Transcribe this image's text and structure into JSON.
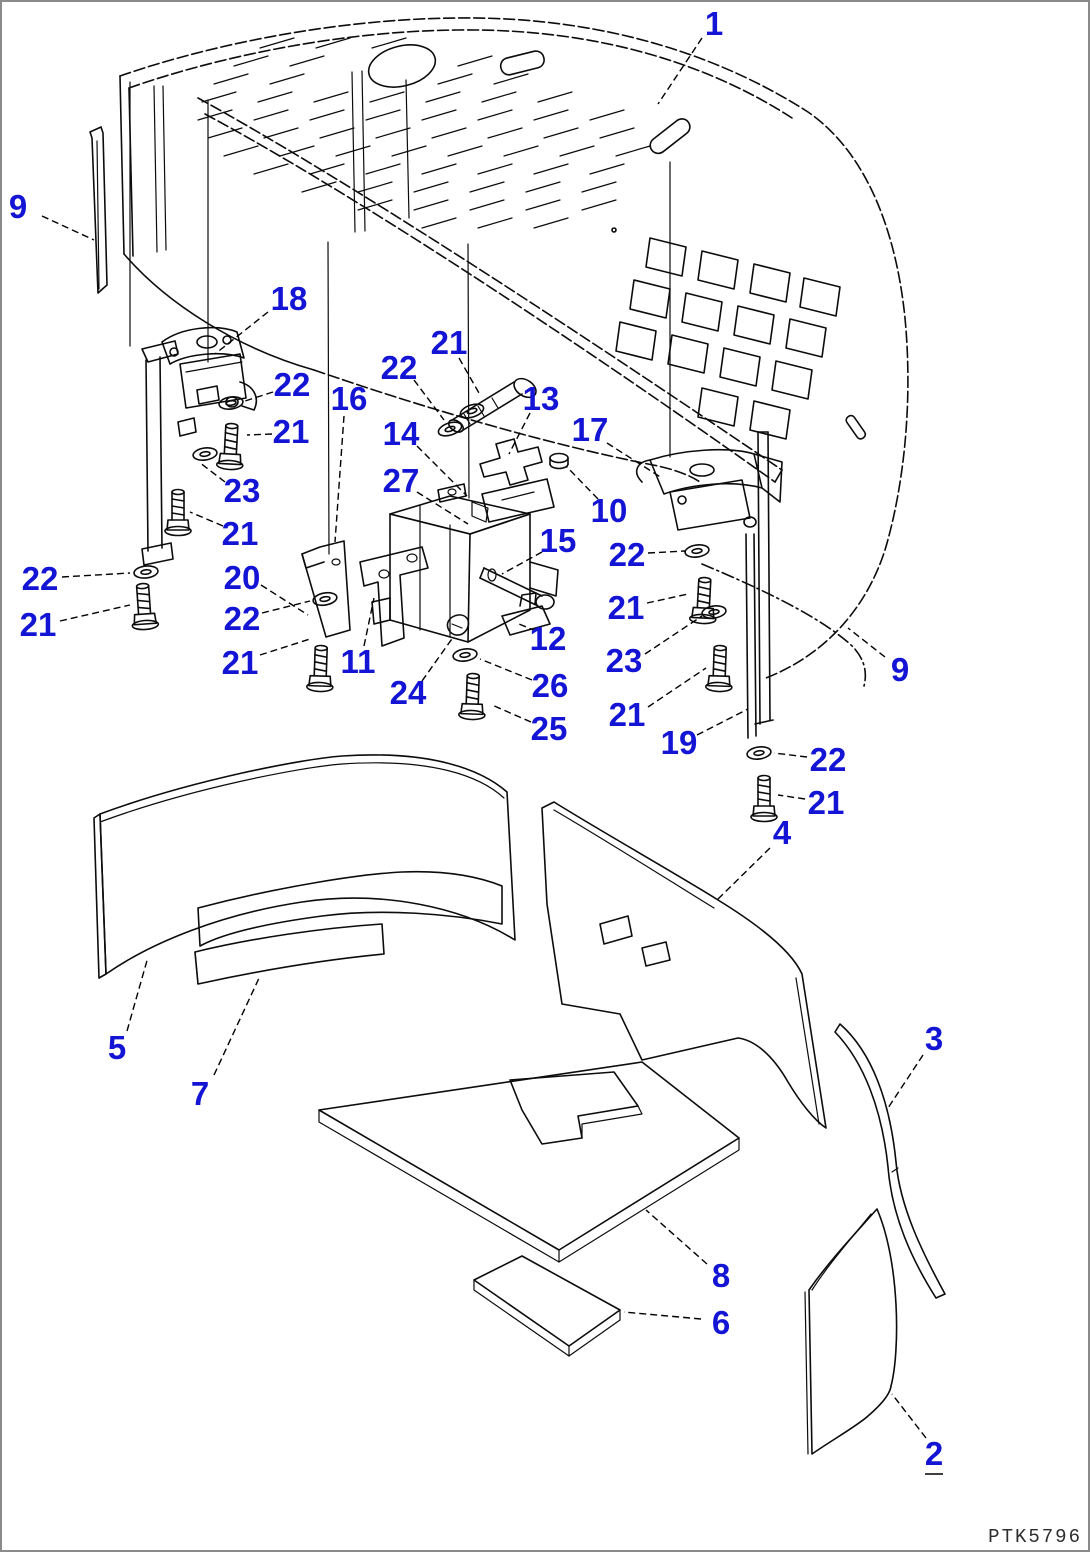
{
  "page": {
    "drawing_code": "PTK5796",
    "background": "#ffffff",
    "border_color": "#8a8a8a"
  },
  "style": {
    "callout_color": "#1414d4",
    "line_color": "#0c0c0c"
  },
  "callouts": [
    {
      "label": "1",
      "x": 712,
      "y": 22,
      "x1": 700,
      "y1": 36,
      "x2": 656,
      "y2": 102
    },
    {
      "label": "9",
      "x": 16,
      "y": 205,
      "x1": 40,
      "y1": 214,
      "x2": 92,
      "y2": 238
    },
    {
      "label": "18",
      "x": 287,
      "y": 297,
      "x1": 266,
      "y1": 310,
      "x2": 213,
      "y2": 352
    },
    {
      "label": "22",
      "x": 290,
      "y": 383,
      "x1": 271,
      "y1": 390,
      "x2": 243,
      "y2": 399
    },
    {
      "label": "21",
      "x": 289,
      "y": 430,
      "x1": 270,
      "y1": 432,
      "x2": 245,
      "y2": 433
    },
    {
      "label": "16",
      "x": 347,
      "y": 397,
      "x1": 342,
      "y1": 414,
      "x2": 333,
      "y2": 540
    },
    {
      "label": "22",
      "x": 397,
      "y": 366,
      "x1": 412,
      "y1": 378,
      "x2": 442,
      "y2": 418
    },
    {
      "label": "21",
      "x": 447,
      "y": 341,
      "x1": 457,
      "y1": 356,
      "x2": 477,
      "y2": 391
    },
    {
      "label": "13",
      "x": 539,
      "y": 397,
      "x1": 528,
      "y1": 411,
      "x2": 507,
      "y2": 452
    },
    {
      "label": "14",
      "x": 399,
      "y": 432,
      "x1": 415,
      "y1": 444,
      "x2": 465,
      "y2": 494
    },
    {
      "label": "17",
      "x": 588,
      "y": 428,
      "x1": 605,
      "y1": 441,
      "x2": 660,
      "y2": 476
    },
    {
      "label": "27",
      "x": 399,
      "y": 479,
      "x1": 415,
      "y1": 490,
      "x2": 466,
      "y2": 522
    },
    {
      "label": "10",
      "x": 607,
      "y": 509,
      "x1": 596,
      "y1": 497,
      "x2": 564,
      "y2": 464
    },
    {
      "label": "23",
      "x": 240,
      "y": 489,
      "x1": 223,
      "y1": 480,
      "x2": 197,
      "y2": 460
    },
    {
      "label": "21",
      "x": 238,
      "y": 532,
      "x1": 221,
      "y1": 524,
      "x2": 188,
      "y2": 510
    },
    {
      "label": "15",
      "x": 556,
      "y": 539,
      "x1": 540,
      "y1": 550,
      "x2": 500,
      "y2": 572
    },
    {
      "label": "22",
      "x": 625,
      "y": 553,
      "x1": 646,
      "y1": 551,
      "x2": 683,
      "y2": 549
    },
    {
      "label": "20",
      "x": 240,
      "y": 576,
      "x1": 259,
      "y1": 583,
      "x2": 306,
      "y2": 613
    },
    {
      "label": "22",
      "x": 38,
      "y": 577,
      "x1": 60,
      "y1": 575,
      "x2": 128,
      "y2": 571
    },
    {
      "label": "21",
      "x": 36,
      "y": 623,
      "x1": 58,
      "y1": 619,
      "x2": 128,
      "y2": 603
    },
    {
      "label": "22",
      "x": 240,
      "y": 617,
      "x1": 260,
      "y1": 611,
      "x2": 308,
      "y2": 599
    },
    {
      "label": "21",
      "x": 624,
      "y": 606,
      "x1": 645,
      "y1": 601,
      "x2": 686,
      "y2": 592
    },
    {
      "label": "21",
      "x": 238,
      "y": 661,
      "x1": 258,
      "y1": 653,
      "x2": 308,
      "y2": 637
    },
    {
      "label": "11",
      "x": 356,
      "y": 660,
      "x1": 362,
      "y1": 644,
      "x2": 372,
      "y2": 596
    },
    {
      "label": "12",
      "x": 546,
      "y": 637,
      "x1": 534,
      "y1": 629,
      "x2": 517,
      "y2": 622
    },
    {
      "label": "23",
      "x": 622,
      "y": 659,
      "x1": 643,
      "y1": 652,
      "x2": 700,
      "y2": 614
    },
    {
      "label": "24",
      "x": 406,
      "y": 691,
      "x1": 420,
      "y1": 679,
      "x2": 452,
      "y2": 634
    },
    {
      "label": "26",
      "x": 548,
      "y": 684,
      "x1": 530,
      "y1": 678,
      "x2": 478,
      "y2": 657
    },
    {
      "label": "21",
      "x": 625,
      "y": 713,
      "x1": 646,
      "y1": 705,
      "x2": 704,
      "y2": 666
    },
    {
      "label": "25",
      "x": 547,
      "y": 727,
      "x1": 529,
      "y1": 720,
      "x2": 490,
      "y2": 703
    },
    {
      "label": "19",
      "x": 677,
      "y": 741,
      "x1": 695,
      "y1": 733,
      "x2": 746,
      "y2": 707
    },
    {
      "label": "9",
      "x": 898,
      "y": 668,
      "x1": 883,
      "y1": 655,
      "x2": 846,
      "y2": 626
    },
    {
      "label": "22",
      "x": 826,
      "y": 758,
      "x1": 805,
      "y1": 755,
      "x2": 772,
      "y2": 751
    },
    {
      "label": "21",
      "x": 824,
      "y": 801,
      "x1": 803,
      "y1": 797,
      "x2": 776,
      "y2": 793
    },
    {
      "label": "4",
      "x": 780,
      "y": 831,
      "x1": 768,
      "y1": 846,
      "x2": 715,
      "y2": 898
    },
    {
      "label": "5",
      "x": 115,
      "y": 1046,
      "x1": 125,
      "y1": 1029,
      "x2": 146,
      "y2": 955
    },
    {
      "label": "7",
      "x": 198,
      "y": 1092,
      "x1": 212,
      "y1": 1073,
      "x2": 258,
      "y2": 974
    },
    {
      "label": "3",
      "x": 932,
      "y": 1037,
      "x1": 921,
      "y1": 1053,
      "x2": 886,
      "y2": 1106
    },
    {
      "label": "8",
      "x": 719,
      "y": 1274,
      "x1": 705,
      "y1": 1262,
      "x2": 644,
      "y2": 1208
    },
    {
      "label": "6",
      "x": 719,
      "y": 1321,
      "x1": 699,
      "y1": 1317,
      "x2": 622,
      "y2": 1310
    },
    {
      "label": "2",
      "x": 932,
      "y": 1452,
      "x1": 924,
      "y1": 1436,
      "x2": 890,
      "y2": 1392,
      "underline": true
    }
  ]
}
